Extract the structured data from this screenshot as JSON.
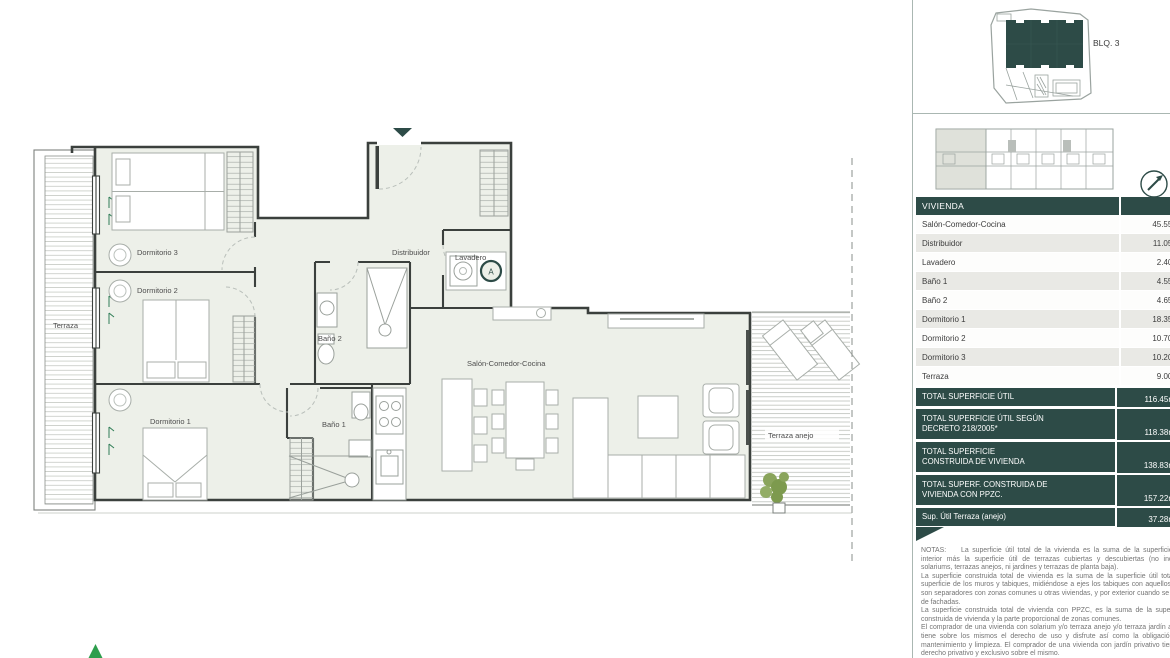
{
  "floor_plan": {
    "room_labels": {
      "terraza": "Terraza",
      "dormitorio3": "Dormitorio 3",
      "dormitorio2": "Dormitorio 2",
      "dormitorio1": "Dormitorio 1",
      "distribuidor": "Distribuidor",
      "lavadero": "Lavadero",
      "bano2": "Baño 2",
      "bano1": "Baño 1",
      "salon": "Salón-Comedor-Cocina",
      "terraza_anejo": "Terraza anejo"
    },
    "unit_marker": "A"
  },
  "site_panel": {
    "block_label": "BLQ. 3"
  },
  "table": {
    "header": "VIVIENDA",
    "rows": [
      {
        "label": "Salón-Comedor-Cocina",
        "value": "45.55m"
      },
      {
        "label": "Distribuidor",
        "value": "11.05m"
      },
      {
        "label": "Lavadero",
        "value": "2.40m"
      },
      {
        "label": "Baño 1",
        "value": "4.55m"
      },
      {
        "label": "Baño 2",
        "value": "4.65m"
      },
      {
        "label": "Dormitorio 1",
        "value": "18.35m"
      },
      {
        "label": "Dormitorio 2",
        "value": "10.70m"
      },
      {
        "label": "Dormitorio 3",
        "value": "10.20m"
      },
      {
        "label": "Terraza",
        "value": "9.00m"
      }
    ],
    "totals": [
      {
        "label": "TOTAL SUPERFICIE ÚTIL",
        "value": "116.45m"
      },
      {
        "label": "TOTAL SUPERFICIE ÚTIL SEGÚN\nDECRETO 218/2005*",
        "value": "118.38m"
      },
      {
        "label": "TOTAL SUPERFICIE\nCONSTRUIDA DE VIVIENDA",
        "value": "138.83m"
      },
      {
        "label": "TOTAL SUPERF. CONSTRUIDA DE\nVIVIENDA CON PPZC.",
        "value": "157.22m"
      },
      {
        "label": "Sup. Útil Terraza (anejo)",
        "value": "37.28m"
      }
    ]
  },
  "notes": {
    "heading": "NOTAS:",
    "paragraphs": [
      "La superficie útil total de la vivienda es la suma de la superficie útil interior más la superficie útil de terrazas cubiertas y descubiertas (no incluye solariums, terrazas anejos, ni jardines y terrazas de planta baja).",
      "La superficie construida total de vivienda es la suma de la superficie útil total, la superficie de los muros y tabiques, midiéndose a ejes los tabiques con aquellos que son separadores con zonas comunes u otras viviendas, y por exterior cuando se trata de fachadas.",
      "La superficie construida total de vivienda con PPZC, es la suma de la superficie construida de vivienda y la parte proporcional de zonas comunes.",
      "El comprador de una vivienda con solarium y/o terraza anejo y/o terraza jardín anejo tiene sobre los mismos el derecho de uso y disfrute así como la obligación de mantenimiento y limpieza. El comprador de una vivienda con jardín privativo tiene el derecho privativo y exclusivo sobre el mismo."
    ]
  },
  "colors": {
    "teal": "#2d4b47",
    "zebra_gray": "#e9e9e5",
    "room_fill": "#edf0e9",
    "accent_green": "#2e9e4d"
  }
}
